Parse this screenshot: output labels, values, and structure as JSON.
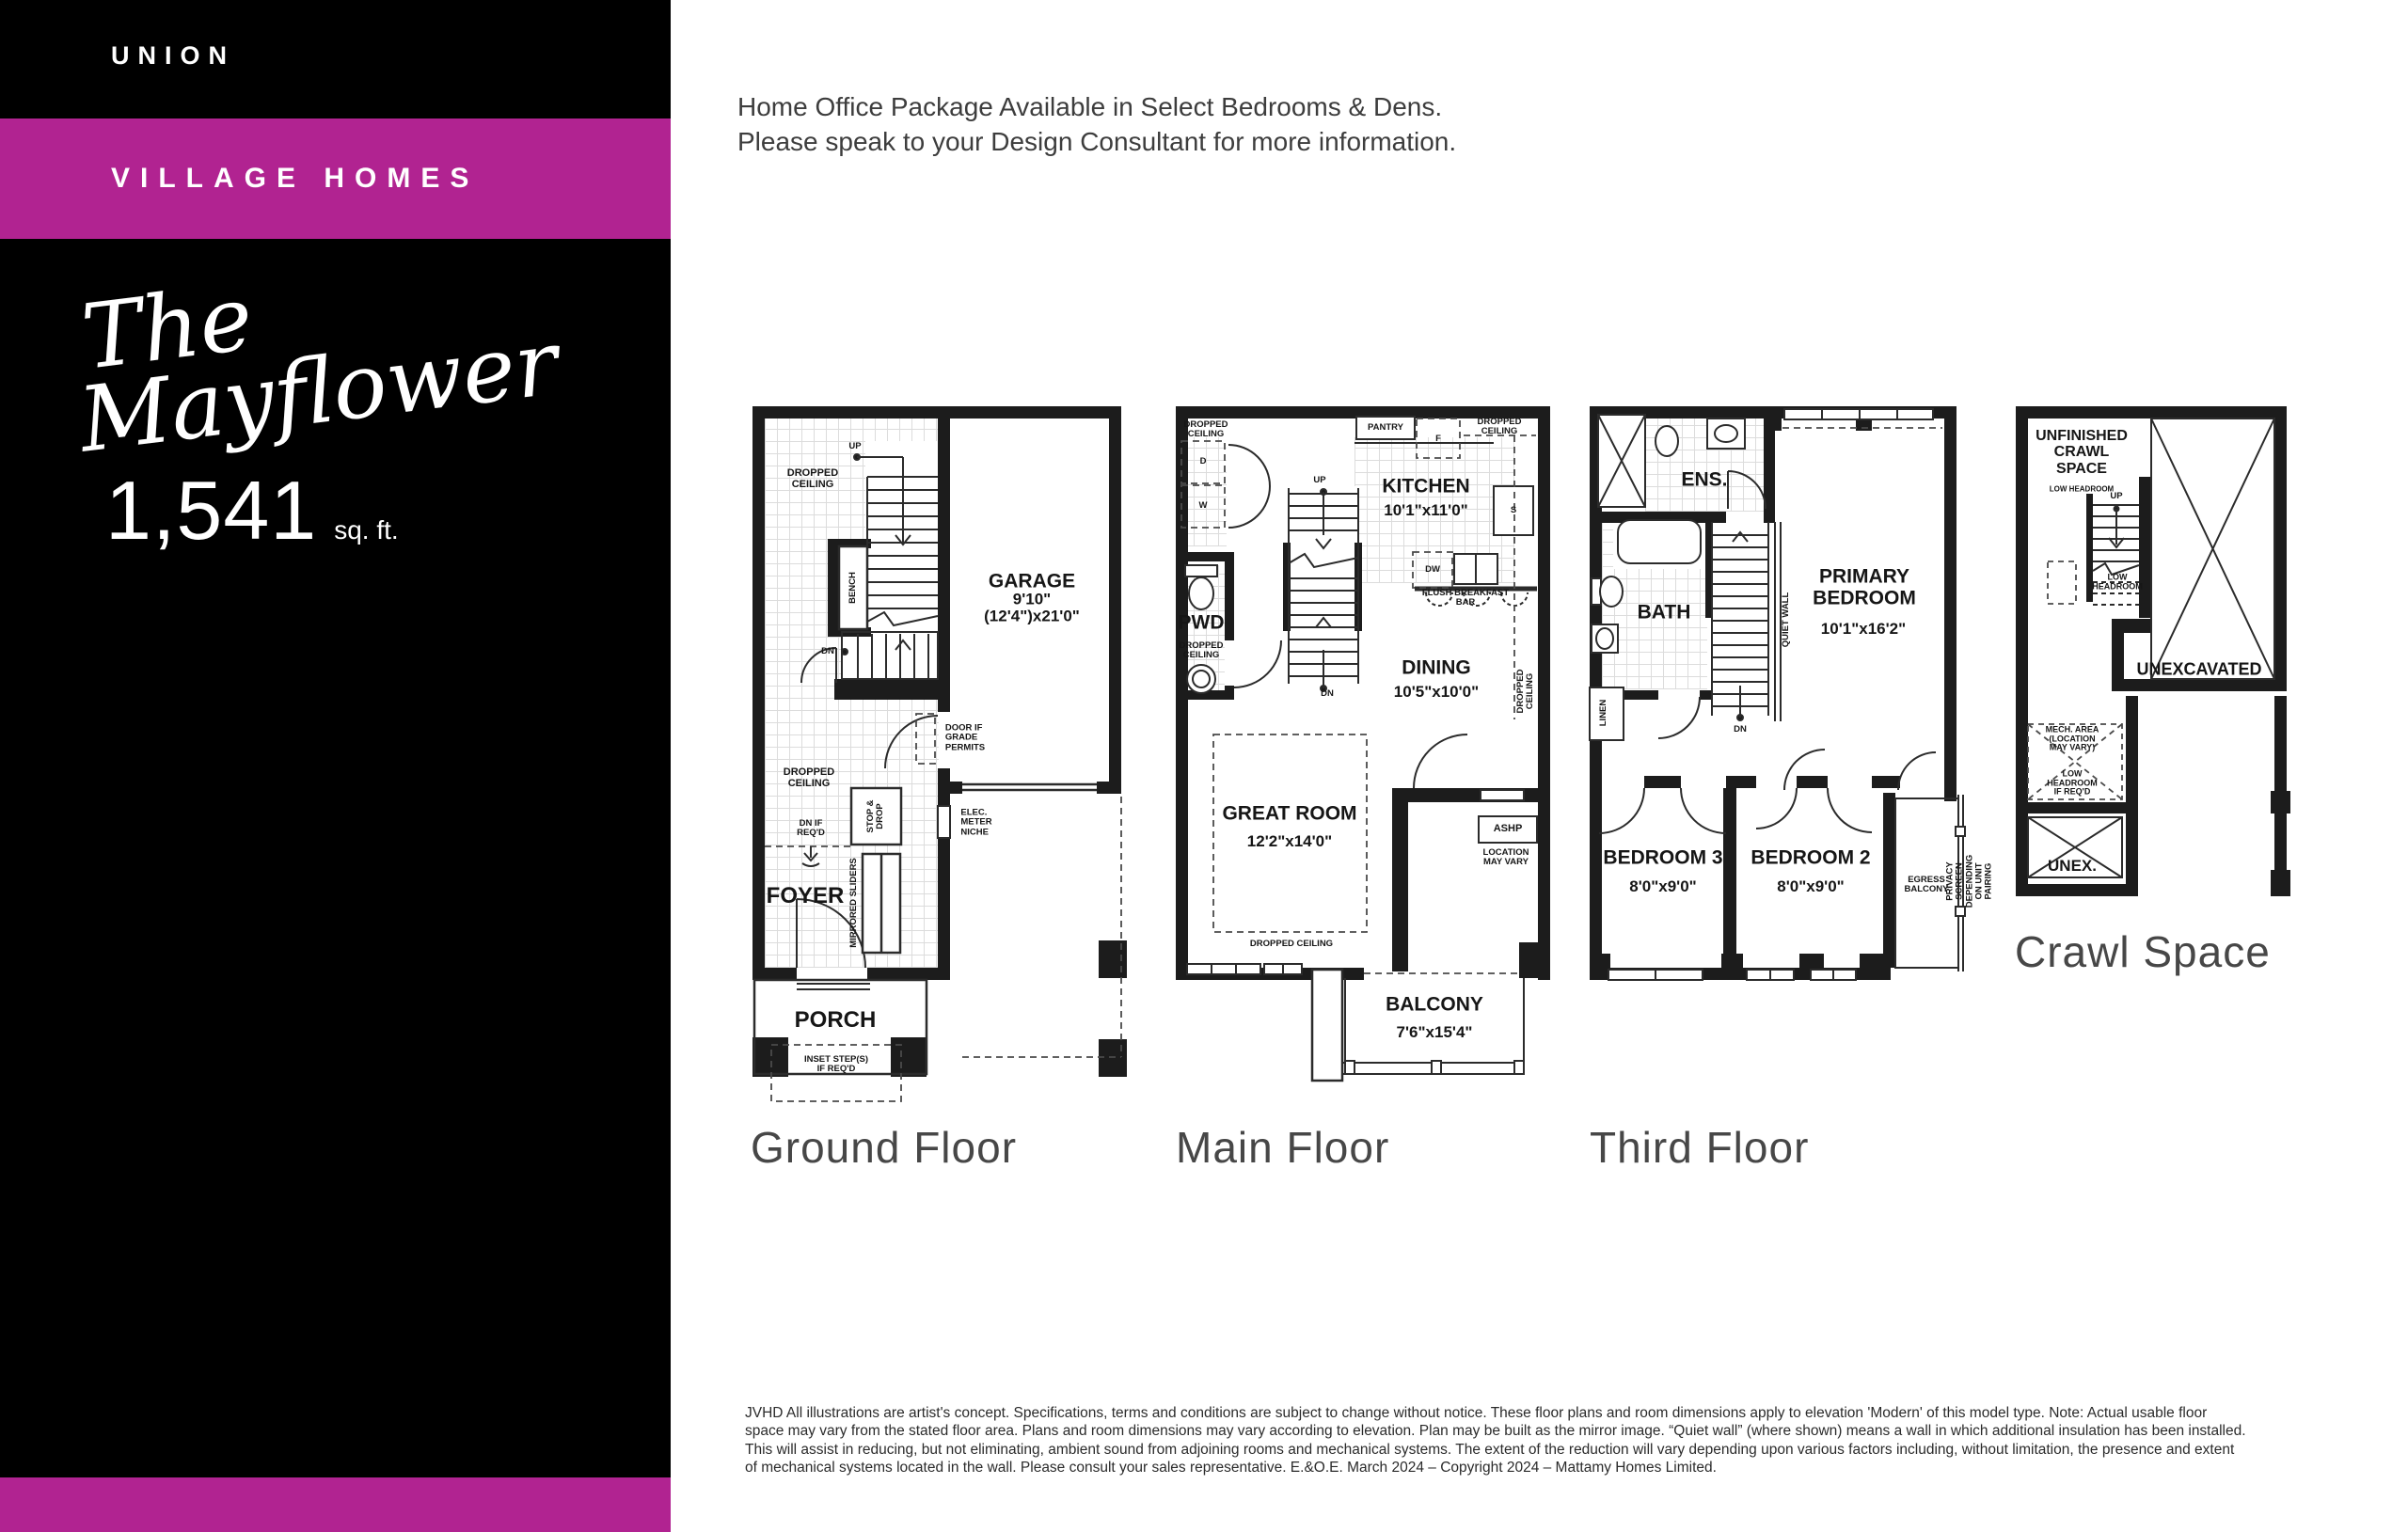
{
  "colors": {
    "accent": "#b12391",
    "sidebar_bg": "#000000",
    "wall": "#1c1c1c"
  },
  "sidebar": {
    "brand": "UNION",
    "collection": "VILLAGE HOMES",
    "model_name": "The\nMayflower",
    "area_value": "1,541",
    "area_unit": "sq. ft."
  },
  "notice": "Home Office Package Available in Select Bedrooms & Dens.\nPlease speak to your Design Consultant for more information.",
  "plans": {
    "ground": {
      "title": "Ground Floor",
      "labels": {
        "up": "UP",
        "dropped_ceiling_top": "DROPPED\nCEILING",
        "bench": "BENCH",
        "dn": "DN",
        "garage": "GARAGE",
        "garage_dim": "9'10\"(12'4\")x21'0\"",
        "door_if_grade": "DOOR IF\nGRADE\nPERMITS",
        "dropped_ceiling_bottom": "DROPPED\nCEILING",
        "stop_drop": "STOP &\nDROP",
        "dn_if_reqd": "DN IF\nREQ'D",
        "elec_meter": "ELEC.\nMETER\nNICHE",
        "foyer": "FOYER",
        "mirrored_sliders": "MIRRORED SLIDERS",
        "porch": "PORCH",
        "inset_steps": "INSET STEP(S)\nIF REQ'D"
      }
    },
    "main": {
      "title": "Main Floor",
      "labels": {
        "dropped_ceiling_tl": "DROPPED\nCEILING",
        "d": "D",
        "w": "W",
        "pantry": "PANTRY",
        "f": "F",
        "dropped_ceiling_tr": "DROPPED CEILING",
        "kitchen": "KITCHEN",
        "kitchen_dim": "10'1\"x11'0\"",
        "s": "S",
        "up": "UP",
        "dw": "DW",
        "flush_bar": "FLUSH BREAKFAST BAR",
        "pwd": "PWD",
        "pwd_ceiling": "DROPPED\nCEILING",
        "dining": "DINING",
        "dining_dim": "10'5\"x10'0\"",
        "dn": "DN",
        "dropped_ceiling_right": "DROPPED CEILING",
        "great_room": "GREAT ROOM",
        "great_room_dim": "12'2\"x14'0\"",
        "dropped_ceiling_bottom": "DROPPED CEILING",
        "ashp": "ASHP",
        "ashp_note": "LOCATION\nMAY VARY",
        "balcony": "BALCONY",
        "balcony_dim": "7'6\"x15'4\""
      }
    },
    "third": {
      "title": "Third Floor",
      "labels": {
        "ens": "ENS.",
        "bath": "BATH",
        "quiet_wall": "QUIET WALL",
        "primary": "PRIMARY\nBEDROOM",
        "primary_dim": "10'1\"x16'2\"",
        "linen": "LINEN",
        "dn": "DN",
        "bedroom3": "BEDROOM 3",
        "bedroom3_dim": "8'0\"x9'0\"",
        "bedroom2": "BEDROOM 2",
        "bedroom2_dim": "8'0\"x9'0\"",
        "egress": "EGRESS\nBALCONY",
        "privacy": "PRIVACY SCREEN DEPENDING\nON UNIT PAIRING"
      }
    },
    "crawl": {
      "title": "Crawl Space",
      "labels": {
        "unfinished": "UNFINISHED\nCRAWL\nSPACE",
        "low_headroom_1": "LOW HEADROOM",
        "up": "UP",
        "low_headroom_2": "LOW\nHEADROOM",
        "unexcavated": "UNEXCAVATED",
        "mech": "MECH. AREA\n(LOCATION\nMAY VARY)",
        "low_headroom_3": "LOW\nHEADROOM\nIF REQ'D",
        "unex": "UNEX."
      }
    }
  },
  "disclaimer": "JVHD All illustrations are artist's concept. Specifications, terms and conditions are subject to change without notice. These floor plans and room dimensions apply to elevation 'Modern' of this model type. Note: Actual usable floor\nspace may vary from the stated floor area. Plans and room dimensions may vary according to elevation. Plan may be built as the mirror image. “Quiet wall” (where shown) means a wall in which additional insulation has been installed.\nThis will assist in reducing, but not eliminating, ambient sound from adjoining rooms and mechanical systems. The extent of the reduction will vary depending upon various factors including, without limitation, the presence and extent\nof mechanical systems located in the wall. Please consult your sales representative. E.&O.E. March 2024 – Copyright 2024 – Mattamy Homes Limited."
}
